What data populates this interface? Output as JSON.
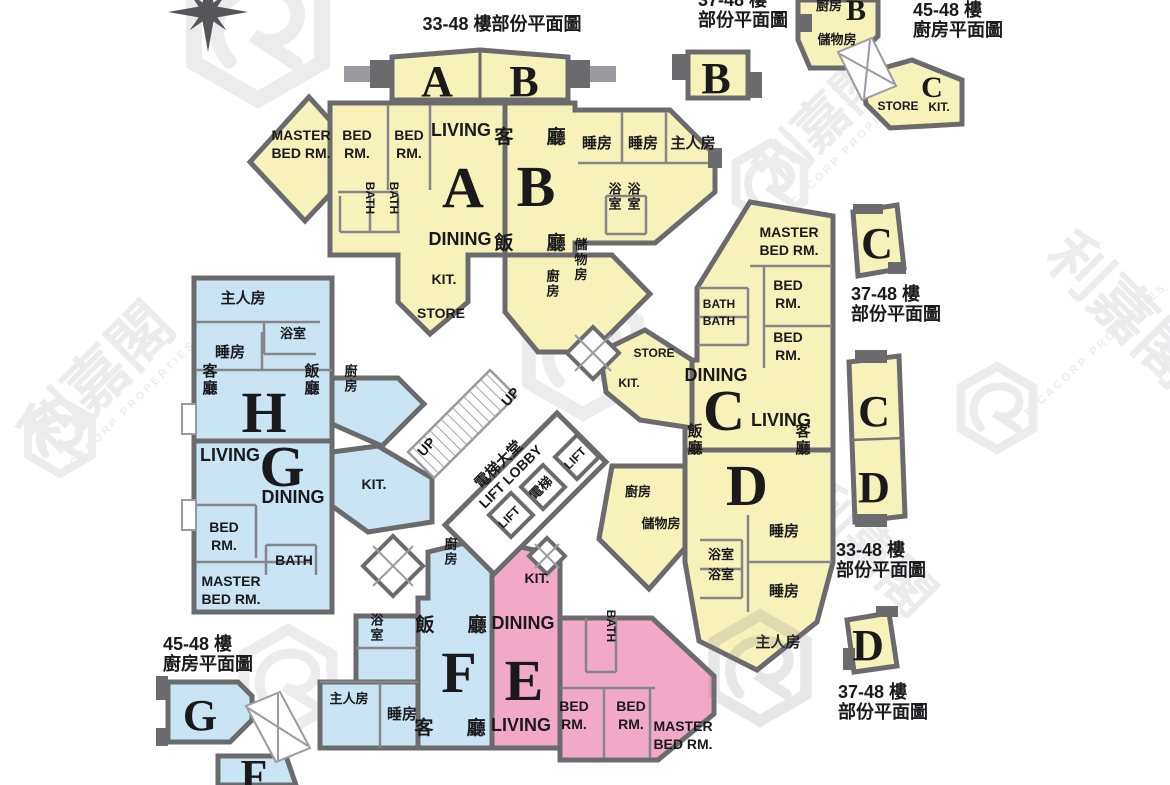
{
  "watermark": {
    "zh": "利嘉閣",
    "en": "RICACORP PROPERTIES"
  },
  "icons": {
    "compass": "compass-rose",
    "logo": "ricacorp-hexagon-logo"
  },
  "colors": {
    "unit_yellow": "#F6F2BA",
    "unit_blue": "#C9E4F3",
    "unit_pink": "#F2A9C7",
    "wall_dark": "#6B6B6E",
    "wall_light": "#9A9AA0",
    "text": "#1A1A1C",
    "watermark": "#DCDCE0"
  },
  "titles": {
    "top_main": "33-48 樓部份平面圖",
    "top_b": [
      "37-48 樓",
      "部份平面圖"
    ],
    "top_right_kitchen": [
      "45-48 樓",
      "廚房平面圖"
    ],
    "right_c": [
      "37-48 樓",
      "部份平面圖"
    ],
    "right_cd": [
      "33-48 樓",
      "部份平面圖"
    ],
    "bottom_right_d": [
      "37-48 樓",
      "部份平面圖"
    ],
    "bottom_left_kitchen": [
      "45-48 樓",
      "廚房平面圖"
    ]
  },
  "core": {
    "up": "UP",
    "lobby_zh": "電梯大堂",
    "lobby_en": "LIFT LOBBY",
    "lift": "LIFT",
    "lift_zh": "電梯"
  },
  "units": {
    "a": {
      "letter": "A",
      "living": "LIVING",
      "dining": "DINING",
      "master": [
        "MASTER",
        "BED RM."
      ],
      "bed": [
        "BED",
        "RM."
      ],
      "bath": "BATH",
      "kit": "KIT.",
      "store": "STORE"
    },
    "b": {
      "letter": "B",
      "living_zh": "客 廳",
      "dining_zh": "飯 廳",
      "bed": "睡房",
      "master": "主人房",
      "bath": "浴室",
      "kit": "廚房",
      "store": "儲物房"
    },
    "c": {
      "letter": "C",
      "living": "LIVING",
      "dining": "DINING",
      "master": [
        "MASTER",
        "BED RM."
      ],
      "bed": [
        "BED",
        "RM."
      ],
      "bath": "BATH",
      "kit": "KIT.",
      "store": "STORE"
    },
    "d": {
      "letter": "D",
      "living_zh": "客廳",
      "dining_zh": "飯廳",
      "bed": "睡房",
      "master": "主人房",
      "bath": "浴室",
      "kit": "廚房",
      "store": "儲物房"
    },
    "e": {
      "letter": "E",
      "living": "LIVING",
      "dining": "DINING",
      "master": [
        "MASTER",
        "BED RM."
      ],
      "bed": [
        "BED",
        "RM."
      ],
      "bath": "BATH",
      "kit": "KIT."
    },
    "f": {
      "letter": "F",
      "living_zh": "客 廳",
      "dining_zh": "飯 廳",
      "bed": "睡房",
      "master": "主人房",
      "bath": "浴室",
      "kit": "廚房"
    },
    "g": {
      "letter": "G",
      "living": "LIVING",
      "dining": "DINING",
      "master": [
        "MASTER",
        "BED RM."
      ],
      "bed": [
        "BED",
        "RM."
      ],
      "bath": "BATH",
      "kit": "KIT."
    },
    "h": {
      "letter": "H",
      "living_zh": "客廳",
      "dining_zh": "飯廳",
      "bed": "睡房",
      "master": "主人房",
      "bath": "浴室",
      "kit": "廚房"
    }
  },
  "small_plans": {
    "top_ab": {
      "a": "A",
      "b": "B"
    },
    "top_b": {
      "b": "B"
    },
    "top_right_kitchen": {
      "kit_zh": "廚房",
      "b": "B",
      "store_zh": "儲物房",
      "store": "STORE",
      "c": "C",
      "kit": "KIT."
    },
    "right_c": {
      "c": "C"
    },
    "right_cd": {
      "c": "C",
      "d": "D"
    },
    "bottom_right_d": {
      "d": "D"
    },
    "bottom_left": {
      "g": "G",
      "f": "F"
    }
  }
}
